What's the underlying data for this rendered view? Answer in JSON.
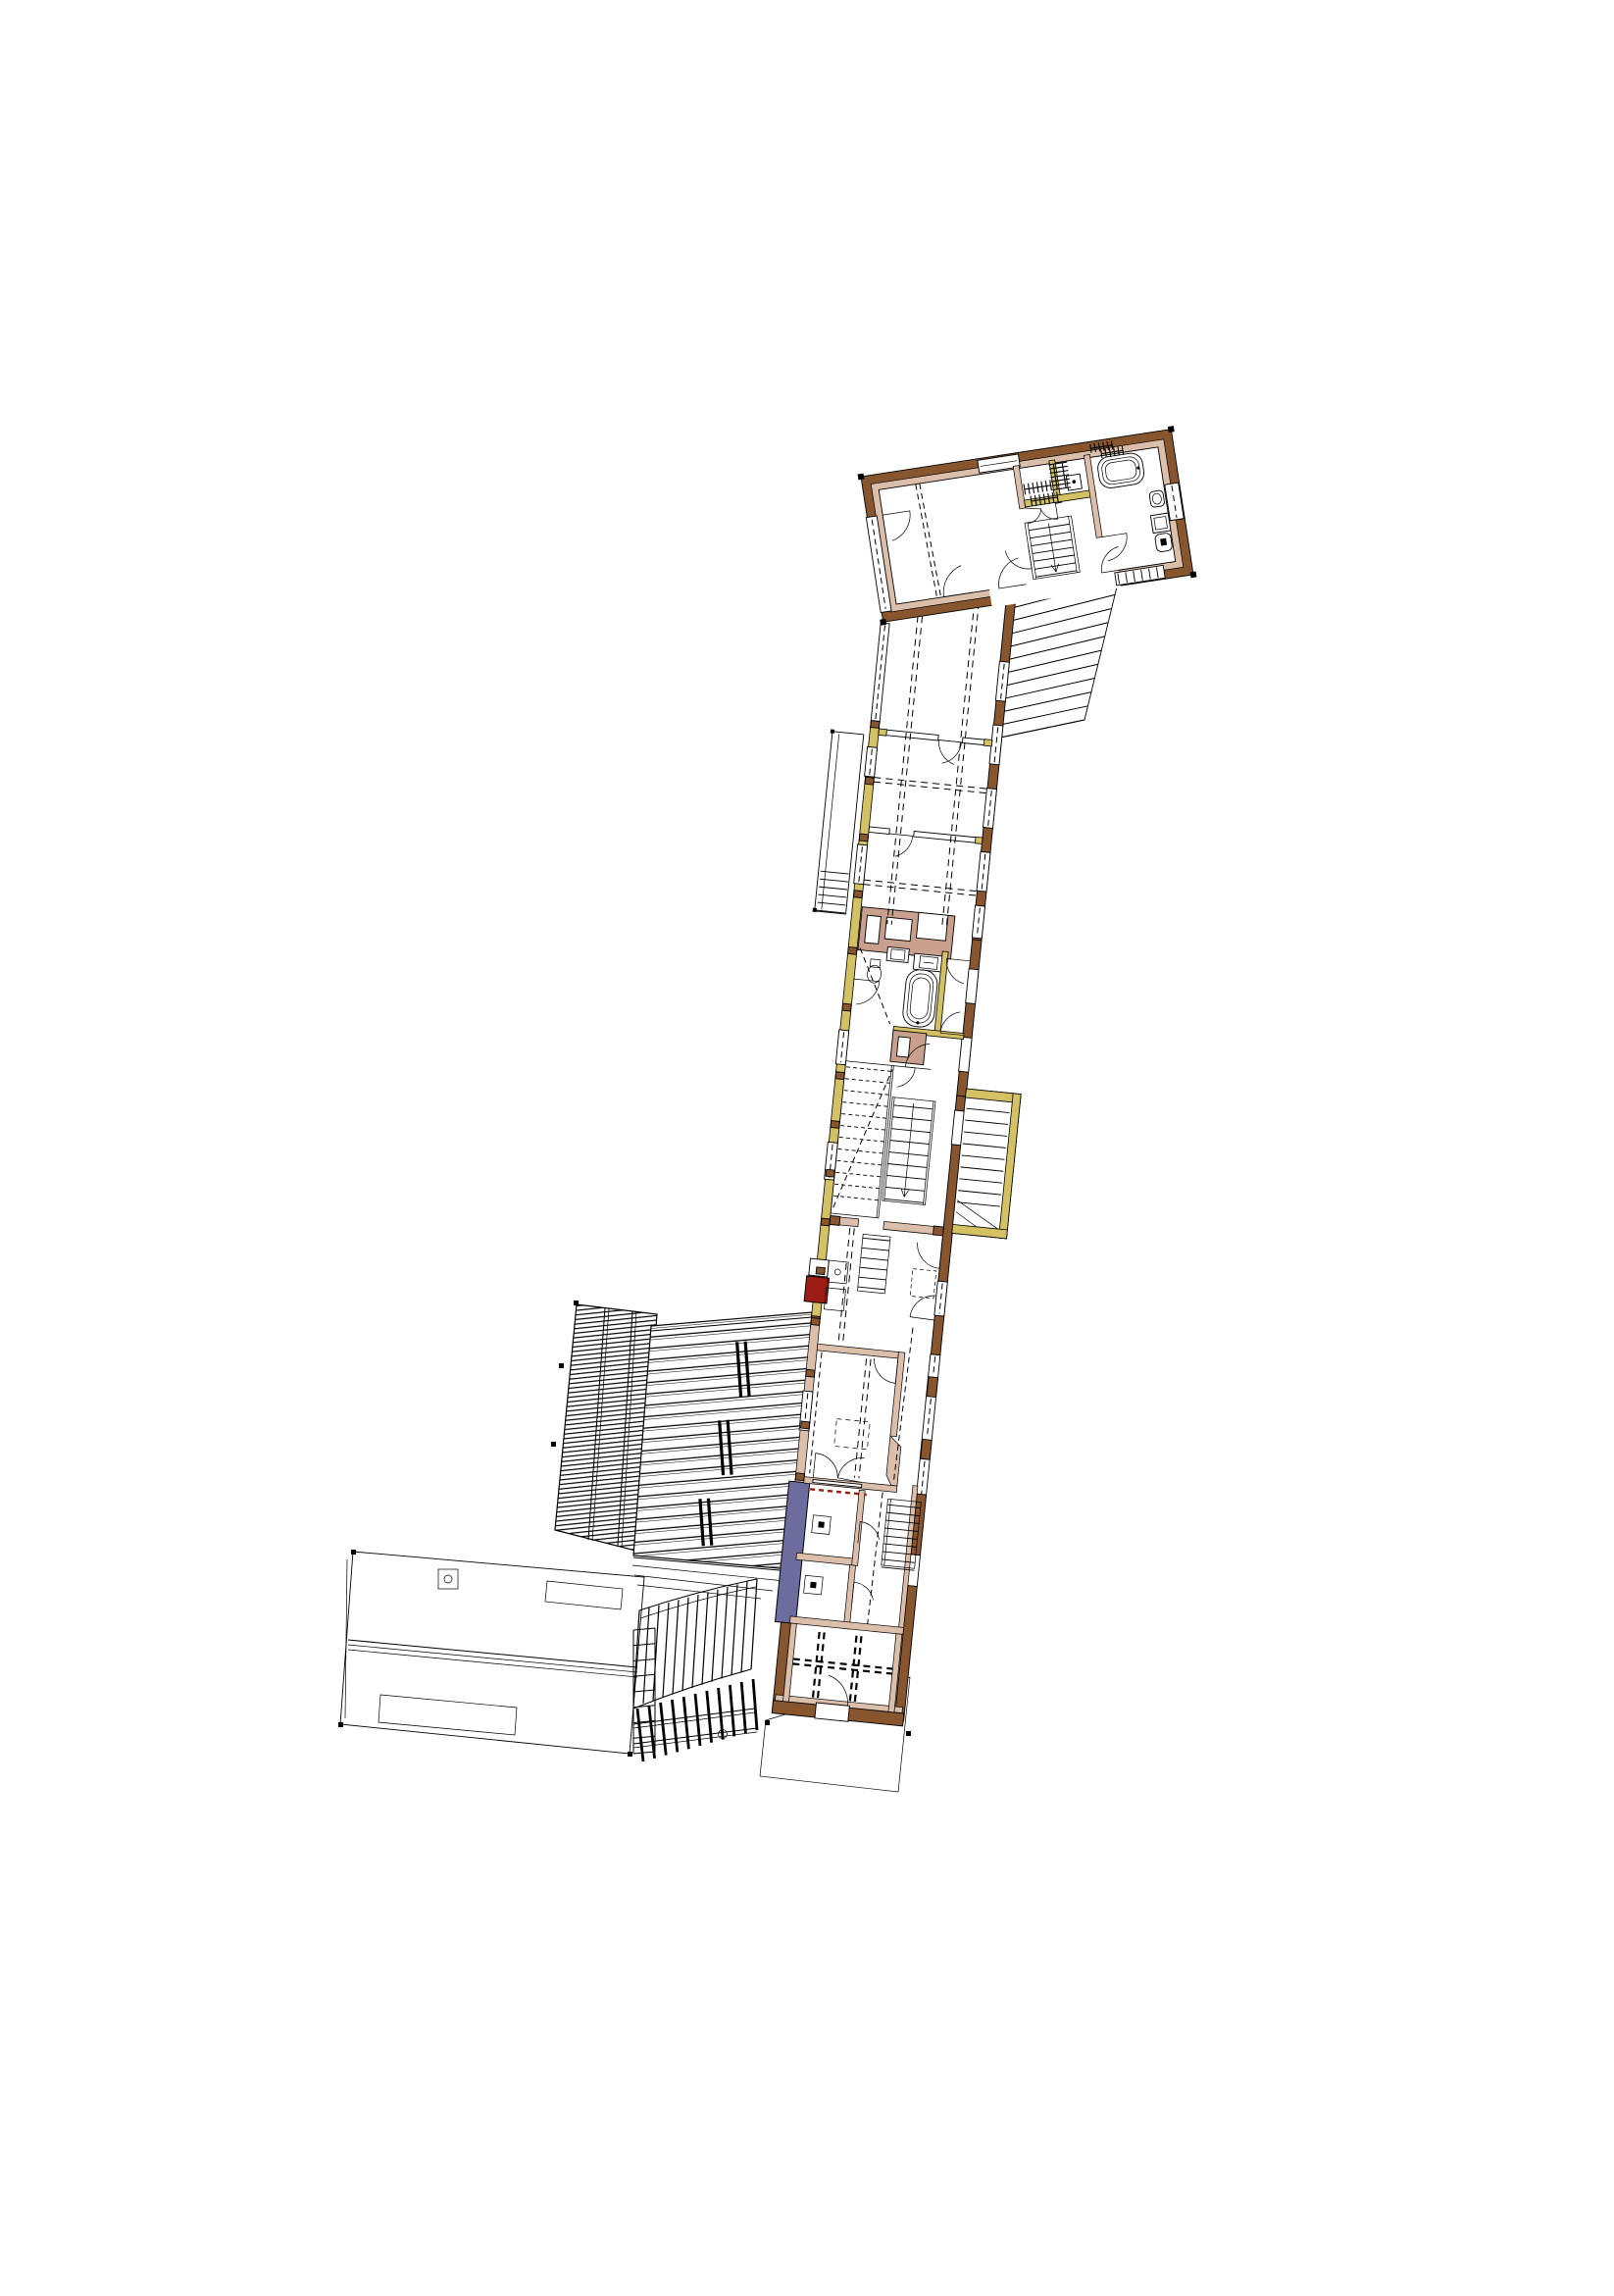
{
  "document": {
    "kind": "architectural floor plan",
    "description": "upper-level plan of a long angled building with annex roofs, no text labels on sheet"
  },
  "palette": {
    "wall_brown": "#87552e",
    "wall_lining_pink": "#dcbfab",
    "masonry_pink": "#c99f8d",
    "timber_yellow": "#d3c163",
    "accent_red": "#9e1c16",
    "accent_blue": "#6c6c9e",
    "line_black": "#000000",
    "paper_white": "#ffffff"
  },
  "plan": {
    "upper_wing": {
      "fixtures": [
        "bathtub",
        "washbasin",
        "shower-tray",
        "toilet",
        "radiator-combs",
        "wardrobe-box",
        "staircase"
      ],
      "wall_types": [
        "brown-masonry",
        "pink-lining",
        "yellow-timber",
        "window-strips"
      ]
    },
    "main_body": {
      "features": [
        "junction-hall",
        "beam-joists-dashed",
        "west-balcony-with-steps",
        "masonry-chimney-block",
        "bathroom-with-tub",
        "toilet",
        "washbasin",
        "stair-hall-double-stair",
        "east-yellow-stair-annex",
        "red-marker-block",
        "living-room-pink-walls",
        "dashed-table",
        "wc-pair",
        "east-straight-stair",
        "blue-wall-segment",
        "red-dashed-sill",
        "beam-grid-end-room"
      ]
    },
    "site": {
      "features": [
        "north-east-exterior-stair",
        "dense-tiled-roof",
        "wide-band-roof",
        "roof-chimney-slots",
        "eaves-lines",
        "gutter-ladder",
        "fan-staircase",
        "pergola-beams",
        "south-annex-roof",
        "roof-ridge",
        "skylight",
        "skylight",
        "chimney-with-flue",
        "terrace-outline"
      ]
    }
  }
}
